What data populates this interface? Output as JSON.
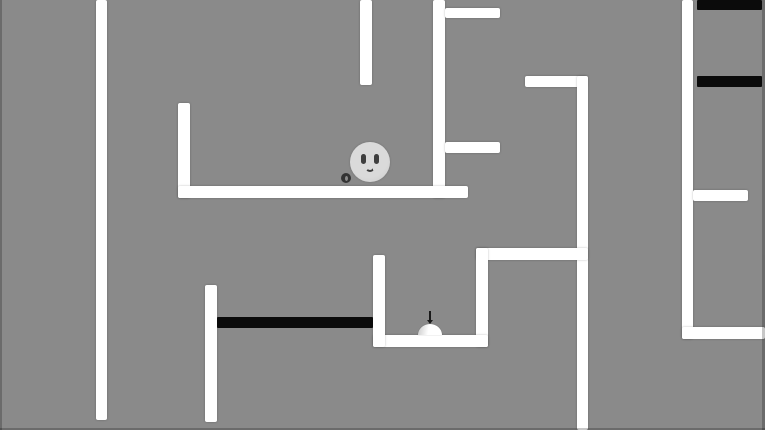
{
  "scene": {
    "width": 765,
    "height": 430,
    "background_color": "#8a8a8a",
    "wall_color": "#ffffff",
    "hazard_color": "#0b0b0b"
  },
  "walls": [
    {
      "x": 96,
      "y": 0,
      "w": 11,
      "h": 420
    },
    {
      "x": 360,
      "y": 0,
      "w": 12,
      "h": 85
    },
    {
      "x": 433,
      "y": 0,
      "w": 12,
      "h": 198
    },
    {
      "x": 445,
      "y": 8,
      "w": 55,
      "h": 10
    },
    {
      "x": 445,
      "y": 142,
      "w": 55,
      "h": 11
    },
    {
      "x": 178,
      "y": 103,
      "w": 12,
      "h": 95
    },
    {
      "x": 178,
      "y": 186,
      "w": 290,
      "h": 12
    },
    {
      "x": 525,
      "y": 76,
      "w": 62,
      "h": 11
    },
    {
      "x": 577,
      "y": 76,
      "w": 11,
      "h": 354
    },
    {
      "x": 476,
      "y": 248,
      "w": 112,
      "h": 12
    },
    {
      "x": 476,
      "y": 248,
      "w": 12,
      "h": 99
    },
    {
      "x": 373,
      "y": 335,
      "w": 115,
      "h": 12
    },
    {
      "x": 373,
      "y": 255,
      "w": 12,
      "h": 92
    },
    {
      "x": 205,
      "y": 285,
      "w": 12,
      "h": 137
    },
    {
      "x": 682,
      "y": 0,
      "w": 11,
      "h": 339
    },
    {
      "x": 693,
      "y": 190,
      "w": 55,
      "h": 11
    },
    {
      "x": 682,
      "y": 327,
      "w": 83,
      "h": 12
    }
  ],
  "hazard_bars": [
    {
      "x": 697,
      "y": 0,
      "w": 65,
      "h": 10
    },
    {
      "x": 697,
      "y": 76,
      "w": 65,
      "h": 11
    },
    {
      "x": 217,
      "y": 317,
      "w": 156,
      "h": 11
    }
  ],
  "player": {
    "x": 370,
    "y": 162,
    "radius": 20,
    "body_color": "#d4d4d4",
    "face_color": "#3e3e3e"
  },
  "pellet": {
    "x": 346,
    "y": 178,
    "radius": 5,
    "color": "#333333",
    "hole_color": "#8a8a8a"
  },
  "dome_item": {
    "x": 430,
    "base_y": 335,
    "width": 24,
    "height": 11,
    "color": "#ffffff",
    "antenna_color": "#1a1a1a",
    "antenna_height": 13
  }
}
